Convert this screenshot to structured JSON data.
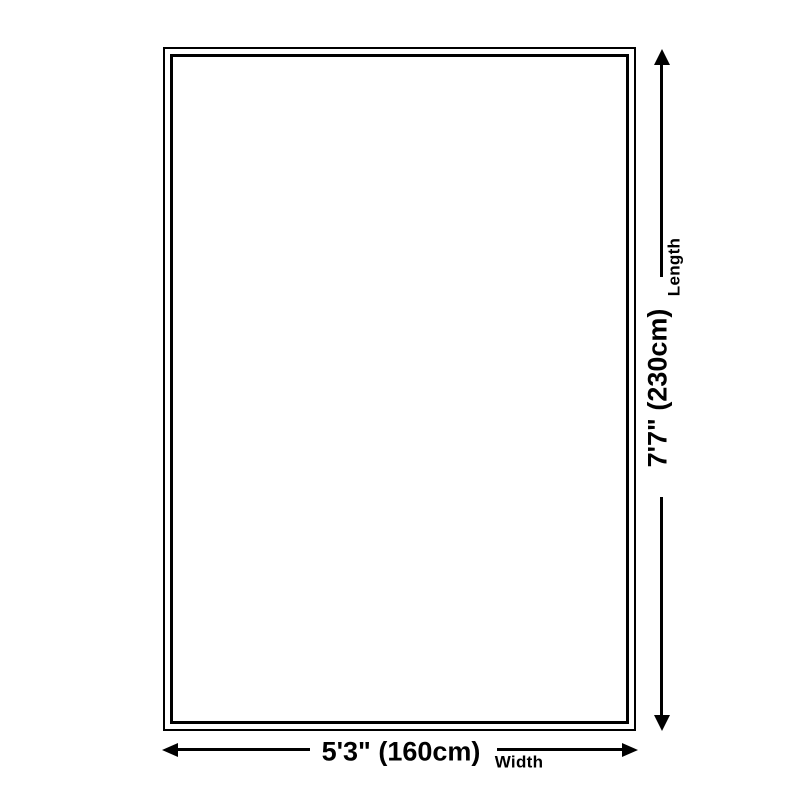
{
  "diagram": {
    "kind": "product-size-diagram",
    "colors": {
      "line": "#000000",
      "background": "#ffffff"
    },
    "length": {
      "label": "Length",
      "value": "7'7\" (230cm)"
    },
    "width": {
      "label": "Width",
      "value": "5'3\" (160cm)"
    }
  }
}
